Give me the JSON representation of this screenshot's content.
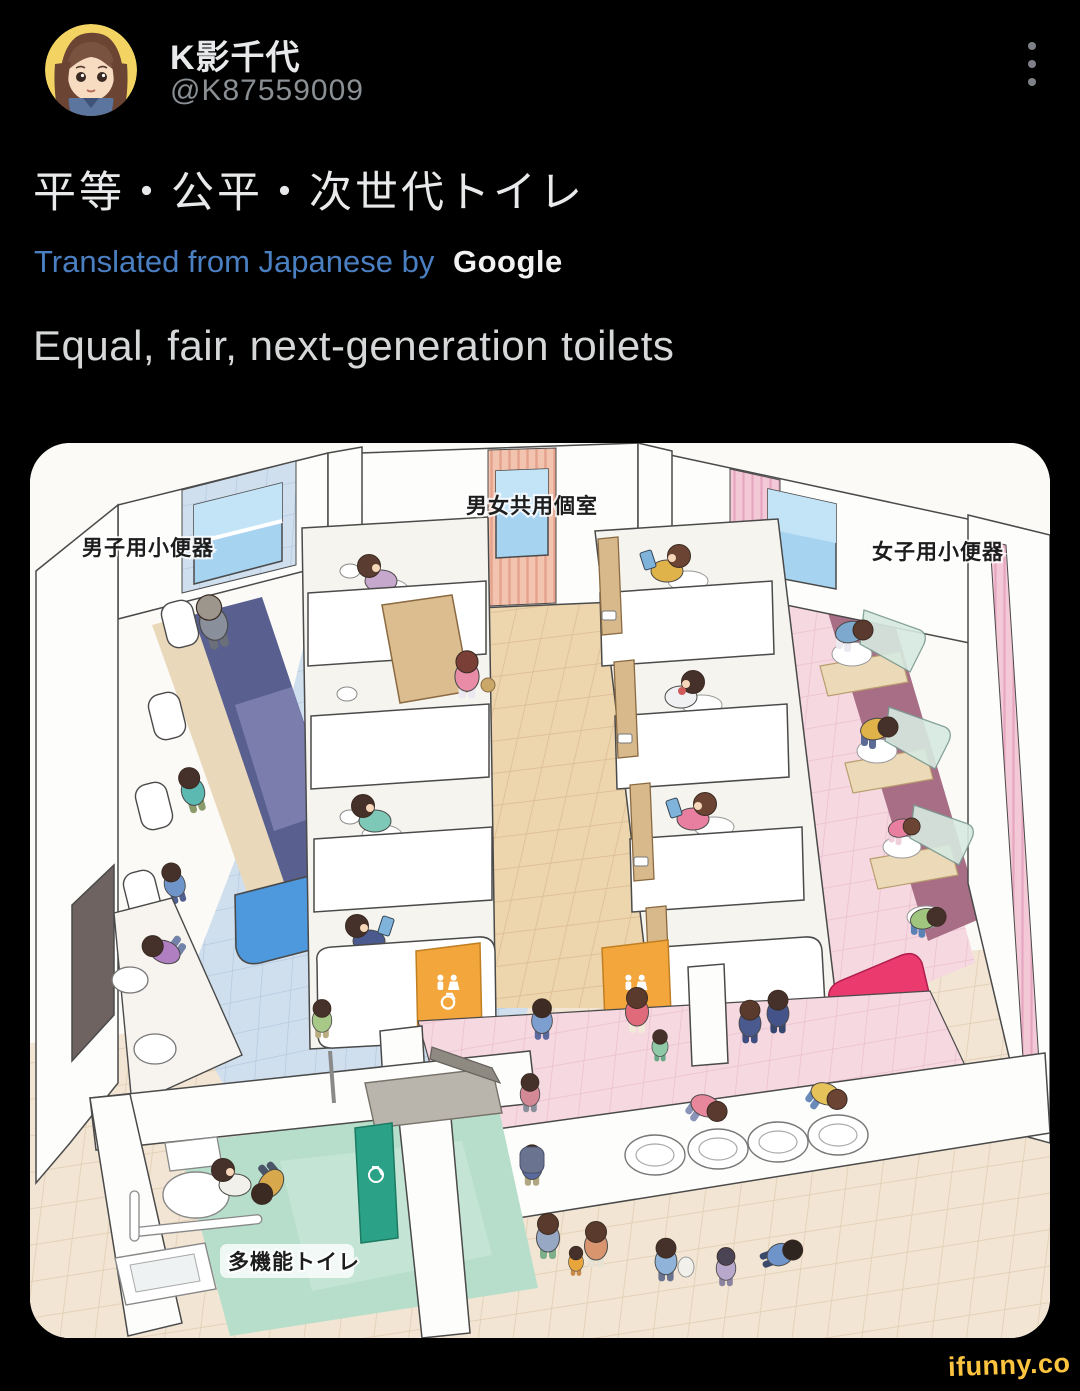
{
  "post": {
    "author_name": "K影千代",
    "author_handle": "@K87559009",
    "text_japanese": "平等・公平・次世代トイレ",
    "translated_prefix": "Translated from Japanese by",
    "translator_brand": "Google",
    "text_translated": "Equal, fair, next-generation toilets"
  },
  "illustration": {
    "labels": {
      "mens_urinals": "男子用小便器",
      "shared_stalls": "男女共用個室",
      "womens_urinals": "女子用小便器",
      "multifunction_toilet": "多機能トイレ"
    }
  },
  "watermark": {
    "text": "ifunny.co"
  },
  "colors": {
    "background": "#000000",
    "author_name": "#e7e9ea",
    "handle_gray": "#8a8f94",
    "tweet_text": "#e7e9ea",
    "translate_blue": "#4a7fc1",
    "translated_text": "#d5d7d8",
    "watermark_yellow": "#fdc53f",
    "sign_orange": "#f2a63c",
    "accent_pink": "#ea3a6e",
    "door_teal": "#2ba287"
  }
}
